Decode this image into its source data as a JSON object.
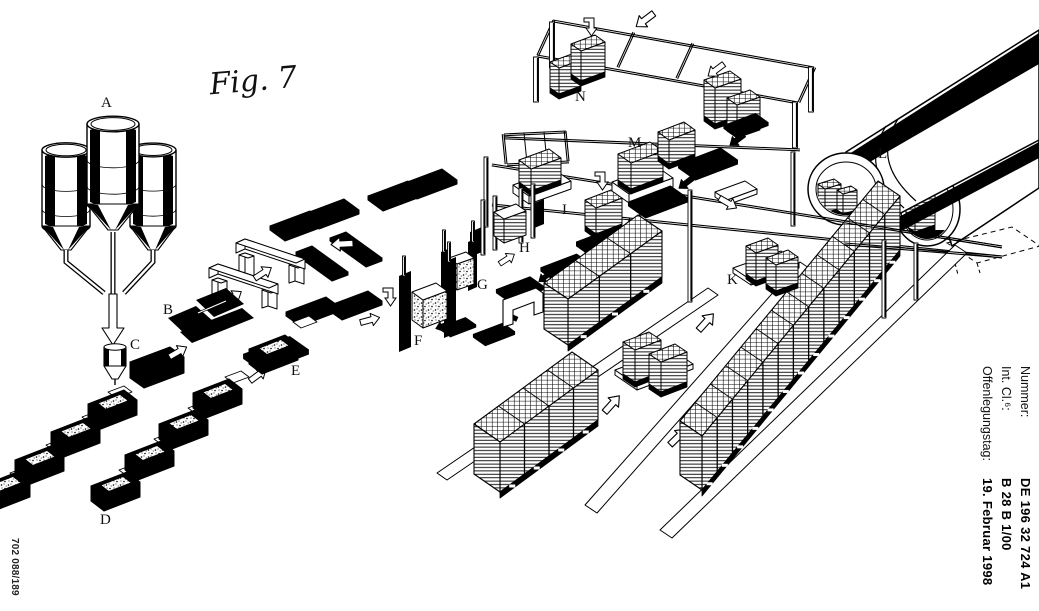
{
  "figure": {
    "title": "Fig. 7",
    "labels": {
      "A": "A",
      "B": "B",
      "C": "C",
      "D": "D",
      "E": "E",
      "F": "F",
      "G": "G",
      "H": "H",
      "I": "I",
      "K": "K",
      "L": "L",
      "M": "M",
      "N": "N"
    }
  },
  "margin": {
    "rows": [
      {
        "label": "Nummer:",
        "value": "DE 196 32 724 A1"
      },
      {
        "label": "Int. Cl.⁶:",
        "value": "B 28 B 1/00"
      },
      {
        "label": "Offenlegungstag:",
        "value": "19. Februar 1998"
      }
    ],
    "print_code": "702 088/189"
  }
}
